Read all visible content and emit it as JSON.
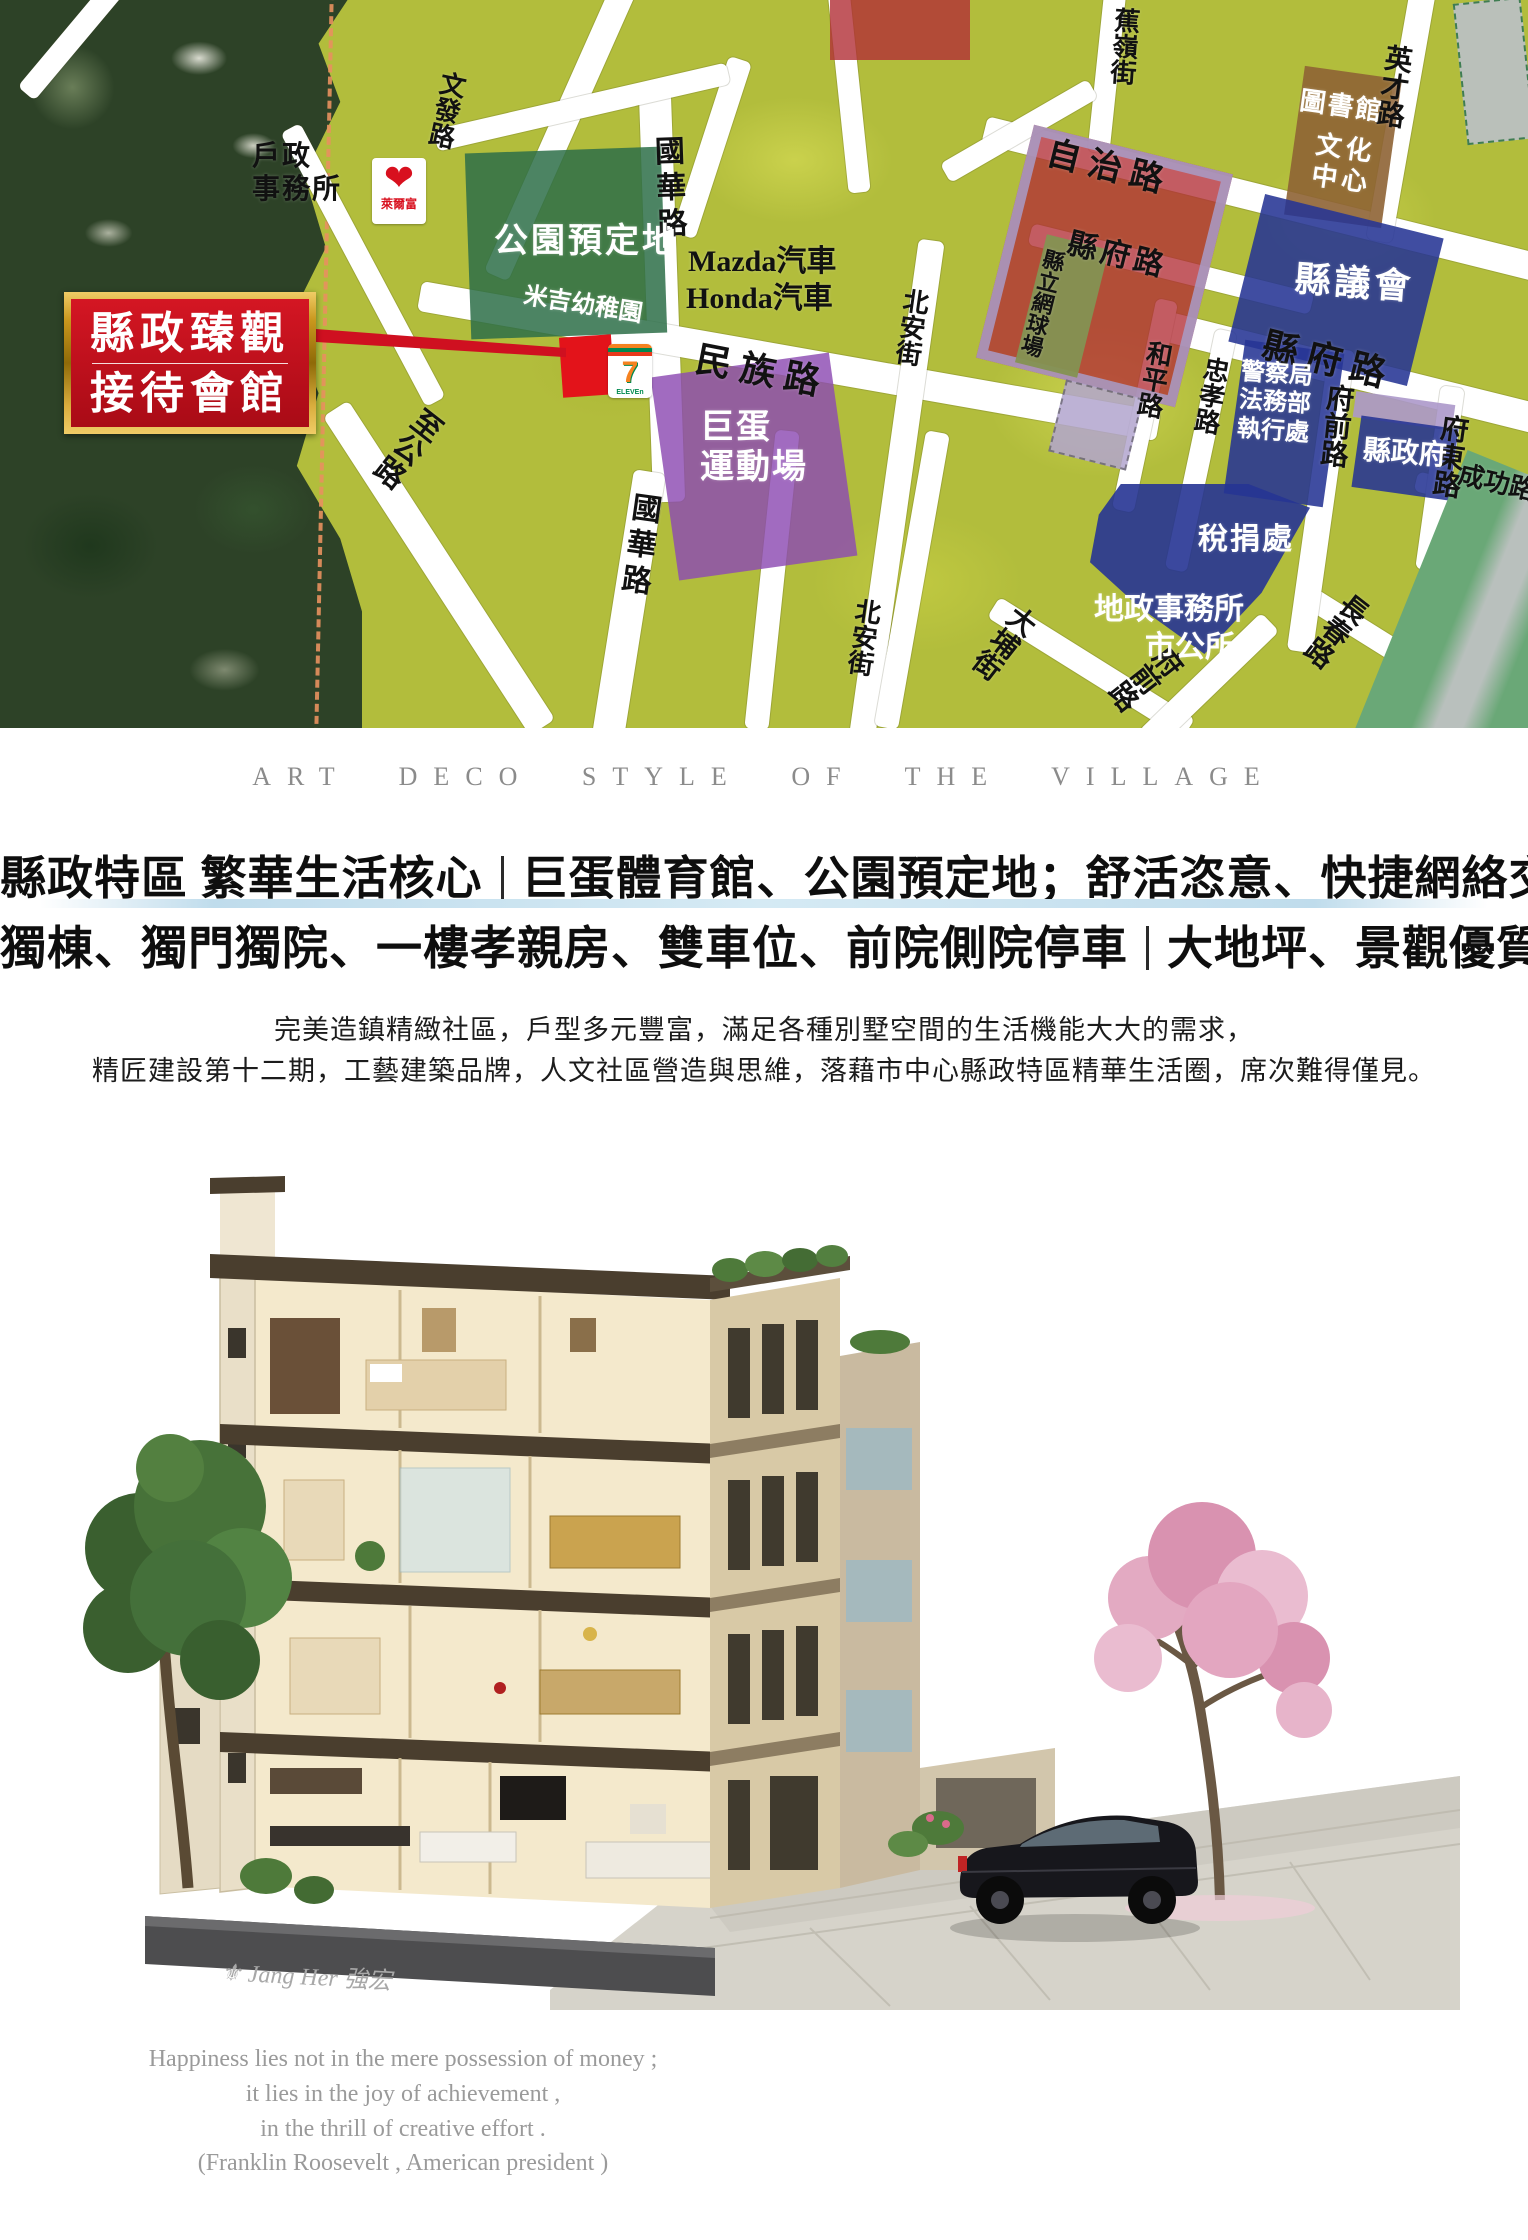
{
  "map": {
    "badge": {
      "line1": "縣政臻觀",
      "line2": "接待會館"
    },
    "logos": {
      "hilife_name": "Hi-Life",
      "hilife_sub": "萊爾富",
      "seven_digit": "7",
      "seven_sub": "ELEVEn"
    },
    "zones": [
      {
        "id": "park-zone",
        "x": 468,
        "y": 150,
        "w": 196,
        "h": 186,
        "rot": -2,
        "bg": "rgba(45,110,72,0.85)"
      },
      {
        "id": "dome-zone",
        "x": 664,
        "y": 364,
        "w": 180,
        "h": 205,
        "rot": -8,
        "bg": "rgba(140,74,178,0.82)"
      },
      {
        "id": "tennis-red-zone",
        "x": 1002,
        "y": 146,
        "w": 205,
        "h": 240,
        "rot": 14,
        "bg": "rgba(178,46,54,0.78)",
        "border": "10px solid rgba(168,156,200,0.85)"
      },
      {
        "id": "tennis-court-zone",
        "x": 1030,
        "y": 240,
        "w": 64,
        "h": 132,
        "rot": 14,
        "bg": "rgba(132,146,82,0.95)"
      },
      {
        "id": "library-zone",
        "x": 1294,
        "y": 72,
        "w": 98,
        "h": 150,
        "rot": 8,
        "bg": "rgba(142,99,52,0.9)"
      },
      {
        "id": "council-zone",
        "x": 1244,
        "y": 214,
        "w": 184,
        "h": 152,
        "rot": 14,
        "bg": "rgba(38,52,148,0.88)"
      },
      {
        "id": "police-zone",
        "x": 1234,
        "y": 346,
        "w": 100,
        "h": 155,
        "rot": 8,
        "bg": "rgba(38,52,148,0.88)"
      },
      {
        "id": "gov-strip-zone",
        "x": 1354,
        "y": 398,
        "w": 100,
        "h": 26,
        "rot": 8,
        "bg": "rgba(172,152,202,0.9)"
      },
      {
        "id": "gov-zone",
        "x": 1356,
        "y": 422,
        "w": 98,
        "h": 72,
        "rot": 8,
        "bg": "rgba(38,52,148,0.88)"
      },
      {
        "id": "tax-zone",
        "x": 1090,
        "y": 484,
        "w": 220,
        "h": 170,
        "rot": 0,
        "bg": "rgba(38,52,148,0.9)",
        "clip": "polygon(14% 0, 72% 0, 100% 14%, 78% 64%, 52% 100%, 22% 72%, 0 46%, 4% 18%)"
      },
      {
        "id": "top-red-zone",
        "x": 830,
        "y": 0,
        "w": 140,
        "h": 60,
        "rot": 0,
        "bg": "rgba(178,46,54,0.8)"
      },
      {
        "id": "lavender-zone",
        "x": 1056,
        "y": 388,
        "w": 80,
        "h": 74,
        "rot": 14,
        "bg": "rgba(178,164,206,0.85)",
        "border": "2px dashed rgba(60,60,60,0.5)"
      },
      {
        "id": "site-block",
        "x": 561,
        "y": 336,
        "w": 52,
        "h": 60,
        "rot": -4,
        "bg": "#e3131a"
      },
      {
        "id": "gray-zone",
        "x": 1460,
        "y": 0,
        "w": 68,
        "h": 142,
        "rot": -6,
        "bg": "#bac0ba",
        "border": "2px dashed #3f7d52"
      },
      {
        "id": "river-zone",
        "x": 1400,
        "y": 468,
        "w": 160,
        "h": 330,
        "rot": 22,
        "bg": "linear-gradient(90deg,#6aa877 0%,#6aa877 32%,#b9c0bd 46%,#b9c0bd 62%,#6aa877 78%,#6aa877 100%)"
      }
    ],
    "labels": [
      {
        "id": "huzheng-label",
        "text": "戶政\n事務所",
        "x": 252,
        "y": 140,
        "size": 28,
        "color": "#111",
        "ls": 2
      },
      {
        "id": "wenfa-road-label",
        "text": "文發路",
        "x": 438,
        "y": 68,
        "size": 26,
        "color": "#111",
        "vert": true,
        "rot": 12
      },
      {
        "id": "zhigong-road-label",
        "text": "至公路",
        "x": 420,
        "y": 400,
        "size": 30,
        "color": "#111",
        "vert": true,
        "rot": 38
      },
      {
        "id": "guohua-road-n-label",
        "text": "國華路",
        "x": 648,
        "y": 136,
        "size": 30,
        "color": "#111",
        "vert": true,
        "rot": -2,
        "ls": 6
      },
      {
        "id": "guohua-road-s-label",
        "text": "國華路",
        "x": 628,
        "y": 490,
        "size": 30,
        "color": "#111",
        "vert": true,
        "rot": 8,
        "ls": 6
      },
      {
        "id": "mazda-label",
        "text": "Mazda汽車",
        "x": 688,
        "y": 244,
        "size": 30,
        "color": "#111"
      },
      {
        "id": "honda-label",
        "text": "Honda汽車",
        "x": 686,
        "y": 281,
        "size": 30,
        "color": "#111"
      },
      {
        "id": "minzu-road-label",
        "text": "民 族 路",
        "x": 700,
        "y": 338,
        "size": 36,
        "color": "#111",
        "rot": 11
      },
      {
        "id": "beian-road-n-label",
        "text": "北安街",
        "x": 900,
        "y": 286,
        "size": 26,
        "color": "#111",
        "vert": true,
        "rot": 8
      },
      {
        "id": "beian-road-s-label",
        "text": "北安街",
        "x": 852,
        "y": 596,
        "size": 26,
        "color": "#111",
        "vert": true,
        "rot": 8
      },
      {
        "id": "jiaoling-road-label",
        "text": "蕉嶺街",
        "x": 1110,
        "y": 6,
        "size": 26,
        "color": "#111",
        "vert": true,
        "rot": 4
      },
      {
        "id": "zizhi-road-label",
        "text": "自 治 路",
        "x": 1052,
        "y": 134,
        "size": 34,
        "color": "#111",
        "rot": 14
      },
      {
        "id": "yingcai-road-label",
        "text": "英才路",
        "x": 1382,
        "y": 42,
        "size": 28,
        "color": "#111",
        "vert": true,
        "rot": 8
      },
      {
        "id": "xianfu-road-n-label",
        "text": "縣府路",
        "x": 1072,
        "y": 226,
        "size": 30,
        "color": "#111",
        "rot": 14,
        "ls": 4
      },
      {
        "id": "xianfu-road-label",
        "text": "縣 府 路",
        "x": 1268,
        "y": 324,
        "size": 36,
        "color": "#111",
        "rot": 14
      },
      {
        "id": "heping-road-label",
        "text": "和平路",
        "x": 1144,
        "y": 338,
        "size": 26,
        "color": "#111",
        "vert": true,
        "rot": 10
      },
      {
        "id": "zhongxiao-road-label",
        "text": "忠孝路",
        "x": 1201,
        "y": 354,
        "size": 26,
        "color": "#111",
        "vert": true,
        "rot": 10
      },
      {
        "id": "fuqian-road-label",
        "text": "府前路",
        "x": 1323,
        "y": 382,
        "size": 28,
        "color": "#111",
        "vert": true,
        "rot": 6
      },
      {
        "id": "fudong-road-label",
        "text": "府東路",
        "x": 1438,
        "y": 412,
        "size": 28,
        "color": "#111",
        "vert": true,
        "rot": 8
      },
      {
        "id": "chenggong-road-label",
        "text": "成功路",
        "x": 1462,
        "y": 460,
        "size": 26,
        "color": "#111",
        "rot": 13
      },
      {
        "id": "dapu-road-label",
        "text": "大埔街",
        "x": 1016,
        "y": 598,
        "size": 28,
        "color": "#111",
        "vert": true,
        "rot": 38
      },
      {
        "id": "changchun-road-label",
        "text": "長春路",
        "x": 1348,
        "y": 586,
        "size": 28,
        "color": "#111",
        "vert": true,
        "rot": 38
      },
      {
        "id": "fuqian-road-s-label",
        "text": "府前路",
        "x": 1168,
        "y": 638,
        "size": 28,
        "color": "#111",
        "vert": true,
        "rot": 52
      },
      {
        "id": "park-label",
        "text": "公園預定地",
        "x": 494,
        "y": 222,
        "size": 34,
        "color": "#fff",
        "ls": 3
      },
      {
        "id": "kindergarten-label",
        "text": "米吉幼稚園",
        "x": 526,
        "y": 282,
        "size": 24,
        "color": "#fff",
        "rot": 9
      },
      {
        "id": "dome-label",
        "text": "巨蛋\n運動場",
        "x": 700,
        "y": 408,
        "size": 34,
        "color": "#fff",
        "ls": 2
      },
      {
        "id": "tennis-label",
        "text": "縣立網球場",
        "x": 1042,
        "y": 246,
        "size": 22,
        "color": "#111",
        "vert": true,
        "rot": 14
      },
      {
        "id": "library-label",
        "text": "圖書館",
        "x": 1302,
        "y": 86,
        "size": 26,
        "color": "#fff",
        "rot": 8,
        "ls": 2
      },
      {
        "id": "culture-center-label",
        "text": "文化\n中心",
        "x": 1318,
        "y": 130,
        "size": 26,
        "color": "#fff",
        "rot": 8,
        "ls": 4
      },
      {
        "id": "council-label",
        "text": "縣議會",
        "x": 1296,
        "y": 258,
        "size": 36,
        "color": "#fff",
        "rot": 4,
        "ls": 4
      },
      {
        "id": "police-label",
        "text": "警察局\n法務部\n執行處",
        "x": 1242,
        "y": 358,
        "size": 24,
        "color": "#fff",
        "rot": 4
      },
      {
        "id": "gov-label",
        "text": "縣政府",
        "x": 1364,
        "y": 434,
        "size": 28,
        "color": "#fff",
        "rot": 4
      },
      {
        "id": "tax-label",
        "text": "稅捐處",
        "x": 1198,
        "y": 522,
        "size": 30,
        "color": "#fff",
        "ls": 2
      },
      {
        "id": "land-office-label",
        "text": "地政事務所",
        "x": 1094,
        "y": 592,
        "size": 30,
        "color": "#fff"
      },
      {
        "id": "city-hall-label",
        "text": "市公所",
        "x": 1145,
        "y": 630,
        "size": 30,
        "color": "#fff"
      }
    ],
    "roads": [
      {
        "x": 548,
        "y": -30,
        "w": 26,
        "h": 320,
        "rot": 24
      },
      {
        "x": 352,
        "y": 110,
        "w": 22,
        "h": 310,
        "rot": -28
      },
      {
        "x": 646,
        "y": 92,
        "w": 32,
        "h": 410,
        "rot": -2
      },
      {
        "x": 612,
        "y": 470,
        "w": 32,
        "h": 280,
        "rot": 9
      },
      {
        "x": 424,
        "y": 378,
        "w": 30,
        "h": 380,
        "rot": -33
      },
      {
        "x": 414,
        "y": 346,
        "w": 750,
        "h": 30,
        "rot": 10
      },
      {
        "x": 1146,
        "y": 360,
        "w": 430,
        "h": 30,
        "rot": 14
      },
      {
        "x": 976,
        "y": 186,
        "w": 580,
        "h": 28,
        "rot": 14
      },
      {
        "x": 1026,
        "y": 258,
        "w": 290,
        "h": 22,
        "rot": 14
      },
      {
        "x": 1414,
        "y": 488,
        "w": 140,
        "h": 20,
        "rot": 14
      },
      {
        "x": 1286,
        "y": 656,
        "w": 270,
        "h": 22,
        "rot": 32
      },
      {
        "x": 976,
        "y": 656,
        "w": 230,
        "h": 24,
        "rot": 32
      },
      {
        "x": 884,
        "y": 238,
        "w": 26,
        "h": 500,
        "rot": 8
      },
      {
        "x": 1134,
        "y": 298,
        "w": 22,
        "h": 215,
        "rot": 12
      },
      {
        "x": 1190,
        "y": 328,
        "w": 22,
        "h": 245,
        "rot": 12
      },
      {
        "x": 1308,
        "y": 348,
        "w": 26,
        "h": 305,
        "rot": 8
      },
      {
        "x": 1196,
        "y": 596,
        "w": 26,
        "h": 170,
        "rot": 46
      },
      {
        "x": 1428,
        "y": 386,
        "w": 24,
        "h": 185,
        "rot": 8
      },
      {
        "x": 1388,
        "y": -12,
        "w": 26,
        "h": 255,
        "rot": 10
      },
      {
        "x": 1096,
        "y": -12,
        "w": 22,
        "h": 165,
        "rot": 6
      },
      {
        "x": 700,
        "y": 55,
        "w": 24,
        "h": 185,
        "rot": 18
      },
      {
        "x": 838,
        "y": -12,
        "w": 22,
        "h": 205,
        "rot": -6
      },
      {
        "x": 432,
        "y": 96,
        "w": 300,
        "h": 22,
        "rot": -13
      },
      {
        "x": 60,
        "y": -30,
        "w": 22,
        "h": 140,
        "rot": 40
      },
      {
        "x": 934,
        "y": 120,
        "w": 170,
        "h": 22,
        "rot": -30
      },
      {
        "x": 760,
        "y": 430,
        "w": 24,
        "h": 300,
        "rot": 6
      },
      {
        "x": 900,
        "y": 430,
        "w": 24,
        "h": 300,
        "rot": 10
      }
    ]
  },
  "tagline": "ART DECO STYLE OF THE VILLAGE",
  "headline": {
    "l1a": "縣政特區 繁華生活核心",
    "l1b": "巨蛋體育館、公園預定地；舒活恣意、快捷網絡交通系統",
    "l2a": "獨棟、獨門獨院、一樓孝親房、雙車位、前院側院停車",
    "l2b": "大地坪、景觀優質別墅社區"
  },
  "paragraph": {
    "line1": "完美造鎮精緻社區，戶型多元豐富，滿足各種別墅空間的生活機能大大的需求，",
    "line2": "精匠建設第十二期，工藝建築品牌，人文社區營造與思維，落藉市中心縣政特區精華生活圈，席次難得僅見。"
  },
  "illustration": {
    "watermark": "⚜ Jang Her 強宏"
  },
  "quote": {
    "line1": "Happiness lies not in the mere possession of money ;",
    "line2": "it lies in the joy of achievement ,",
    "line3": "in the thrill of creative effort .",
    "line4": "(Franklin Roosevelt , American president )"
  }
}
